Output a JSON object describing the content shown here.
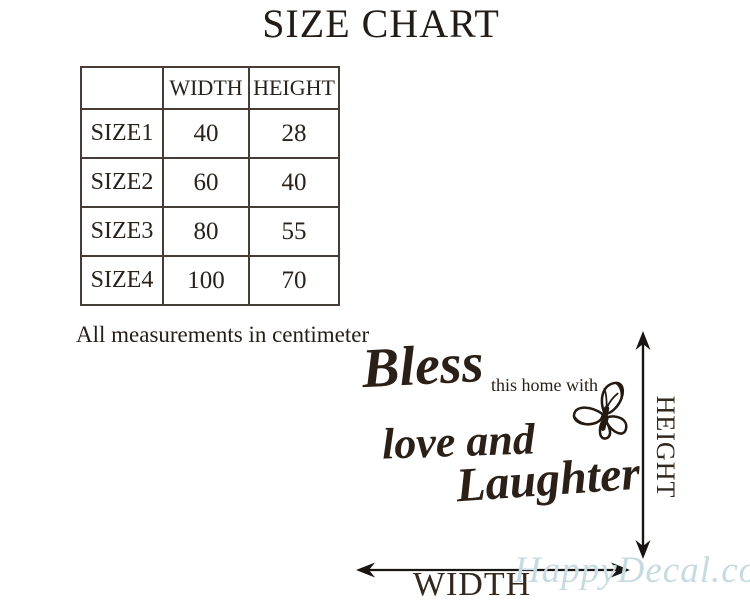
{
  "title": "SIZE CHART",
  "size_table": {
    "headers": [
      "",
      "WIDTH",
      "HEIGHT"
    ],
    "rows": [
      {
        "name": "SIZE1",
        "width": "40",
        "height": "28"
      },
      {
        "name": "SIZE2",
        "width": "60",
        "height": "40"
      },
      {
        "name": "SIZE3",
        "width": "80",
        "height": "55"
      },
      {
        "name": "SIZE4",
        "width": "100",
        "height": "70"
      }
    ]
  },
  "note": "All measurements in centimeter",
  "decal_preview": {
    "script_word1": "Bless",
    "plain_phrase": "this home with",
    "script_word2": "love and",
    "script_word3": "Laughter",
    "butterfly_icon": "butterfly"
  },
  "dimension_labels": {
    "height": "HEIGHT",
    "width": "WIDTH"
  },
  "watermark": "HappyDecal.com",
  "colors": {
    "ink": "#2e241c",
    "table-border": "#473c36",
    "watermark": "#c6dae1",
    "background": "#ffffff"
  }
}
